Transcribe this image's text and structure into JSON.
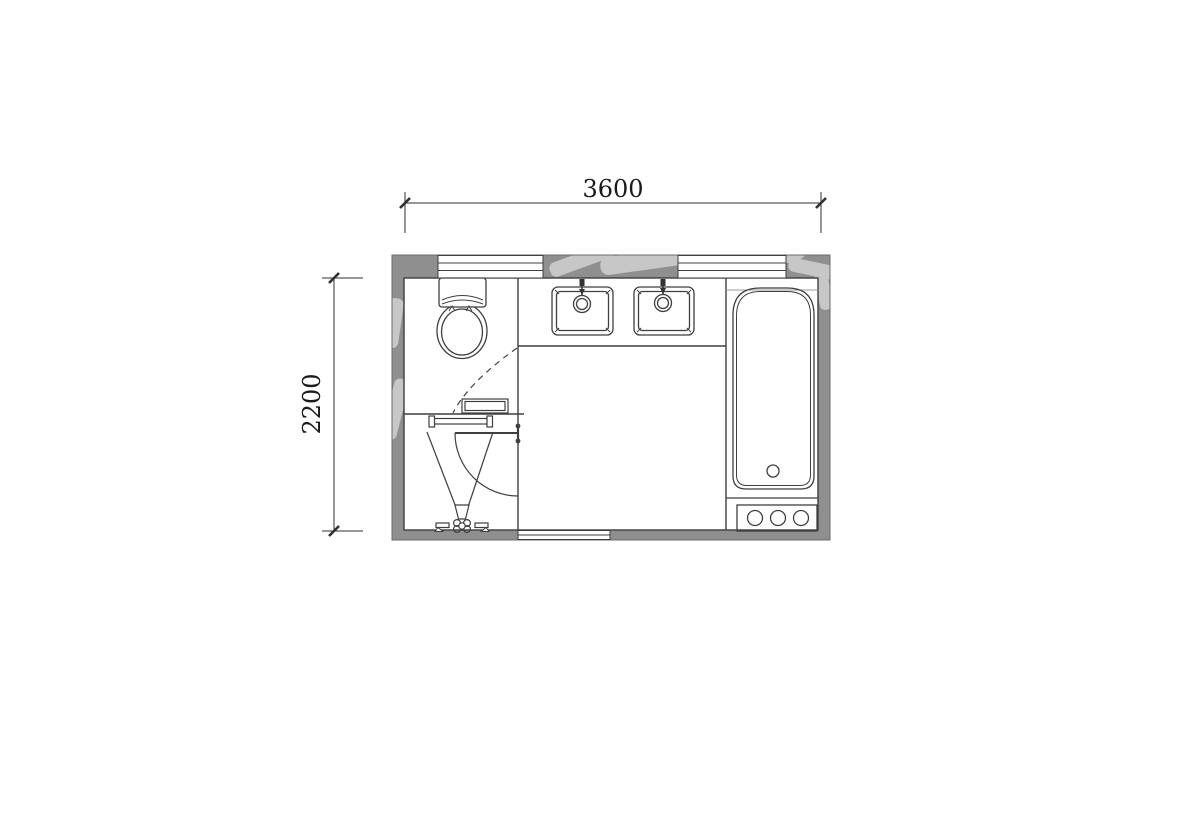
{
  "title": "bathroom-floor-plan",
  "dimensions": {
    "width_label": "3600",
    "height_label": "2200"
  },
  "colors": {
    "wall_fill": "#8f8f8f",
    "line": "#3f3f3f",
    "dim_line": "#2f2f2f",
    "dim_text": "#1a1a1a",
    "background": "#ffffff",
    "watermark": "rgba(255,255,255,0.5)"
  },
  "fixtures": [
    "toilet-icon",
    "sink-left-icon",
    "sink-right-icon",
    "bathtub-icon",
    "tub-control-panel-icon",
    "shower-head-icon",
    "door-icon",
    "towel-bar-icon",
    "shelf-icon",
    "window-top-left-icon",
    "window-top-right-icon",
    "window-bottom-icon"
  ]
}
